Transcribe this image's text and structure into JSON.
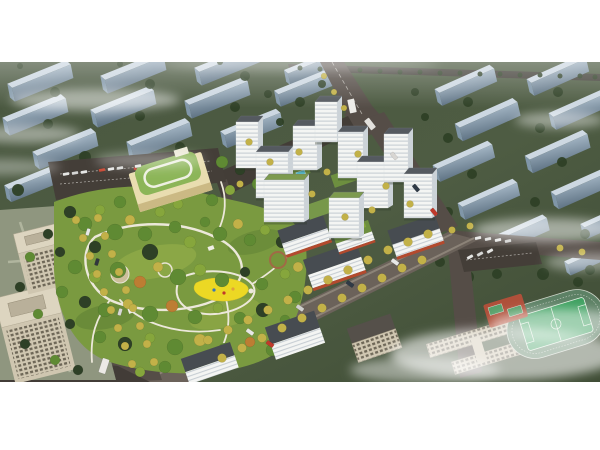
{
  "image": {
    "alt": "Aerial architectural rendering of a residential development: white high-rise towers around green courtyards, a central landscaped park with winding paths and a yellow playground, a kindergarten with green roof, office towers at lower left, a school with sports field at lower right, tree-lined boulevards and rows of background buildings under wisps of cloud",
    "width": 600,
    "height": 320,
    "top_margin": 62,
    "bottom_margin": 68
  },
  "palette": {
    "page_bg": "#ffffff",
    "bg_green": "#4a5840",
    "bg_green_dark": "#3f4d35",
    "slab_top": "#cdd8e2",
    "slab_front_hi": "#a3b5c4",
    "slab_front_lo": "#5f7384",
    "slab_side": "#8096a8",
    "tree_dark": "#2e4026",
    "tree_mid": "#4a6b2f",
    "tree_green": "#5f8a33",
    "tree_light": "#86a63c",
    "tree_yellow": "#c2b148",
    "tree_orange": "#bd7d33",
    "tree_red": "#a34527",
    "road": "#554d47",
    "road_dark": "#423c37",
    "road_light": "#6b625a",
    "parking": "#443e38",
    "path": "#ece8da",
    "park_base": "#7a9a40",
    "park_dark": "#5d7f33",
    "park_light": "#93ac48",
    "playground_yellow": "#ecd824",
    "tower_front": "#f4f5f3",
    "tower_stripe": "#c3cad0",
    "tower_side": "#ccd3d8",
    "tower_roof": "#555a60",
    "tower_roof_green": "#7d9a4e",
    "storefront_red": "#b34a2e",
    "school_wall": "#e9ddb0",
    "school_roof": "#8cb558",
    "office_wall": "#cfc6b0",
    "office_window": "#6e6757",
    "office_roof": "#ddd5c0",
    "field_green": "#3fa161",
    "track_green": "#5d8165",
    "court_red": "#b5503a",
    "pool_blue": "#57c4d6",
    "cloud_white": "#ffffff"
  },
  "scene": {
    "background_slabs": [
      [
        5,
        10,
        -11,
        1
      ],
      [
        98,
        2,
        -11,
        1
      ],
      [
        192,
        -6,
        -11,
        1
      ],
      [
        282,
        -2,
        -11,
        0.85
      ],
      [
        0,
        44,
        -11,
        1
      ],
      [
        88,
        36,
        -11,
        1
      ],
      [
        182,
        27,
        -11,
        1
      ],
      [
        272,
        18,
        -11,
        0.9
      ],
      [
        30,
        78,
        -11,
        1
      ],
      [
        124,
        68,
        -11,
        1
      ],
      [
        218,
        58,
        -11,
        0.95
      ],
      [
        2,
        112,
        -11,
        0.95
      ],
      [
        96,
        102,
        -11,
        0.9
      ],
      [
        432,
        16,
        -13,
        0.95
      ],
      [
        524,
        6,
        -13,
        0.95
      ],
      [
        452,
        50,
        -13,
        1
      ],
      [
        546,
        40,
        -13,
        0.95
      ],
      [
        430,
        92,
        -13,
        0.95
      ],
      [
        522,
        82,
        -13,
        1
      ],
      [
        455,
        130,
        -13,
        0.95
      ],
      [
        548,
        118,
        -13,
        1
      ],
      [
        488,
        165,
        -13,
        0.9
      ],
      [
        578,
        152,
        -13,
        0.85
      ],
      [
        562,
        190,
        -13,
        0.8
      ]
    ],
    "bg_trees": [
      [
        55,
        30,
        5
      ],
      [
        150,
        22,
        5
      ],
      [
        245,
        14,
        5
      ],
      [
        48,
        62,
        5
      ],
      [
        140,
        54,
        5
      ],
      [
        235,
        45,
        5
      ],
      [
        85,
        95,
        6
      ],
      [
        180,
        85,
        5
      ],
      [
        18,
        128,
        6
      ],
      [
        268,
        32,
        4
      ],
      [
        300,
        40,
        5
      ],
      [
        322,
        22,
        4
      ],
      [
        20,
        4,
        3
      ],
      [
        120,
        2,
        3
      ],
      [
        220,
        0,
        3
      ],
      [
        280,
        60,
        4
      ],
      [
        310,
        70,
        4
      ],
      [
        468,
        40,
        5
      ],
      [
        558,
        30,
        5
      ],
      [
        448,
        76,
        5
      ],
      [
        540,
        66,
        5
      ],
      [
        472,
        112,
        5
      ],
      [
        562,
        100,
        5
      ],
      [
        448,
        150,
        5
      ],
      [
        535,
        140,
        5
      ],
      [
        505,
        185,
        6
      ],
      [
        585,
        172,
        5
      ],
      [
        468,
        215,
        6
      ],
      [
        497,
        212,
        5
      ],
      [
        543,
        212,
        6
      ],
      [
        578,
        220,
        5
      ],
      [
        590,
        208,
        5
      ],
      [
        440,
        200,
        5
      ],
      [
        425,
        55,
        4
      ],
      [
        415,
        30,
        4
      ],
      [
        300,
        6,
        2.5
      ],
      [
        320,
        7,
        2.5
      ],
      [
        340,
        8,
        2.5
      ],
      [
        360,
        8,
        2.5
      ],
      [
        380,
        9,
        2.5
      ],
      [
        400,
        10,
        2.5
      ],
      [
        420,
        10,
        2.5
      ],
      [
        440,
        11,
        2.5
      ],
      [
        460,
        11,
        2.5
      ],
      [
        480,
        12,
        2.5
      ],
      [
        500,
        12,
        2.5
      ],
      [
        520,
        13,
        2.5
      ],
      [
        540,
        13,
        2.5
      ],
      [
        560,
        14,
        2.5
      ],
      [
        580,
        14,
        2.5
      ],
      [
        595,
        15,
        2.5
      ]
    ],
    "park_trees": [
      [
        70,
        150,
        6,
        "d"
      ],
      [
        85,
        162,
        7,
        "g"
      ],
      [
        100,
        148,
        5,
        "l"
      ],
      [
        115,
        170,
        8,
        "g"
      ],
      [
        95,
        185,
        6,
        "d"
      ],
      [
        130,
        158,
        5,
        "y"
      ],
      [
        145,
        172,
        7,
        "g"
      ],
      [
        160,
        150,
        5,
        "l"
      ],
      [
        175,
        165,
        6,
        "g"
      ],
      [
        150,
        190,
        8,
        "d"
      ],
      [
        190,
        180,
        6,
        "l"
      ],
      [
        205,
        160,
        5,
        "g"
      ],
      [
        220,
        172,
        7,
        "g"
      ],
      [
        238,
        162,
        5,
        "y"
      ],
      [
        250,
        178,
        6,
        "g"
      ],
      [
        265,
        168,
        5,
        "l"
      ],
      [
        282,
        180,
        6,
        "d"
      ],
      [
        295,
        170,
        5,
        "g"
      ],
      [
        75,
        205,
        7,
        "g"
      ],
      [
        95,
        215,
        6,
        "l"
      ],
      [
        118,
        208,
        8,
        "g"
      ],
      [
        140,
        220,
        6,
        "o"
      ],
      [
        158,
        205,
        5,
        "y"
      ],
      [
        178,
        215,
        8,
        "g"
      ],
      [
        200,
        208,
        6,
        "l"
      ],
      [
        222,
        218,
        7,
        "g"
      ],
      [
        245,
        210,
        5,
        "d"
      ],
      [
        262,
        222,
        6,
        "g"
      ],
      [
        285,
        212,
        5,
        "l"
      ],
      [
        85,
        240,
        6,
        "d"
      ],
      [
        105,
        248,
        7,
        "g"
      ],
      [
        128,
        242,
        5,
        "y"
      ],
      [
        150,
        252,
        8,
        "g"
      ],
      [
        172,
        244,
        6,
        "o"
      ],
      [
        195,
        255,
        7,
        "g"
      ],
      [
        218,
        246,
        5,
        "l"
      ],
      [
        240,
        256,
        6,
        "g"
      ],
      [
        263,
        248,
        7,
        "d"
      ],
      [
        285,
        258,
        5,
        "g"
      ],
      [
        100,
        275,
        6,
        "g"
      ],
      [
        125,
        282,
        7,
        "d"
      ],
      [
        150,
        276,
        5,
        "l"
      ],
      [
        175,
        285,
        8,
        "g"
      ],
      [
        200,
        278,
        6,
        "y"
      ],
      [
        225,
        288,
        7,
        "g"
      ],
      [
        250,
        280,
        5,
        "o"
      ],
      [
        272,
        288,
        6,
        "g"
      ],
      [
        60,
        190,
        5,
        "d"
      ],
      [
        62,
        230,
        6,
        "g"
      ],
      [
        70,
        262,
        5,
        "d"
      ],
      [
        295,
        235,
        6,
        "g"
      ],
      [
        298,
        205,
        5,
        "y"
      ],
      [
        222,
        100,
        6,
        "g"
      ],
      [
        240,
        108,
        5,
        "d"
      ],
      [
        258,
        122,
        6,
        "g"
      ],
      [
        230,
        128,
        5,
        "l"
      ],
      [
        212,
        138,
        6,
        "g"
      ],
      [
        178,
        142,
        5,
        "l"
      ],
      [
        120,
        140,
        6,
        "g"
      ],
      [
        48,
        172,
        5,
        "d"
      ],
      [
        30,
        195,
        5,
        "g"
      ],
      [
        20,
        225,
        5,
        "d"
      ],
      [
        38,
        252,
        5,
        "g"
      ],
      [
        25,
        282,
        5,
        "d"
      ],
      [
        55,
        298,
        5,
        "g"
      ],
      [
        78,
        308,
        5,
        "d"
      ],
      [
        165,
        305,
        6,
        "g"
      ],
      [
        140,
        310,
        5,
        "l"
      ],
      [
        192,
        300,
        5,
        "y"
      ]
    ],
    "street_trees": [
      [
        76,
        158,
        4
      ],
      [
        83,
        176,
        4
      ],
      [
        90,
        194,
        4
      ],
      [
        97,
        212,
        4
      ],
      [
        104,
        230,
        4
      ],
      [
        111,
        248,
        4
      ],
      [
        118,
        266,
        4
      ],
      [
        125,
        284,
        4
      ],
      [
        132,
        302,
        4
      ],
      [
        98,
        156,
        4
      ],
      [
        105,
        174,
        4
      ],
      [
        112,
        192,
        4
      ],
      [
        119,
        210,
        4
      ],
      [
        126,
        228,
        4
      ],
      [
        133,
        246,
        4
      ],
      [
        140,
        264,
        4
      ],
      [
        147,
        282,
        4
      ],
      [
        154,
        300,
        4
      ],
      [
        208,
        278,
        4.5
      ],
      [
        228,
        268,
        4.5
      ],
      [
        248,
        258,
        4.5
      ],
      [
        268,
        248,
        4.5
      ],
      [
        288,
        238,
        4.5
      ],
      [
        308,
        228,
        4.5
      ],
      [
        328,
        218,
        4.5
      ],
      [
        348,
        208,
        4.5
      ],
      [
        368,
        198,
        4.5
      ],
      [
        388,
        188,
        4.5
      ],
      [
        408,
        180,
        4.5
      ],
      [
        428,
        172,
        4.5
      ],
      [
        222,
        296,
        4.5
      ],
      [
        242,
        286,
        4.5
      ],
      [
        262,
        276,
        4.5
      ],
      [
        282,
        266,
        4.5
      ],
      [
        302,
        256,
        4.5
      ],
      [
        322,
        246,
        4.5
      ],
      [
        342,
        236,
        4.5
      ],
      [
        362,
        226,
        4.5
      ],
      [
        382,
        216,
        4.5
      ],
      [
        402,
        206,
        4.5
      ],
      [
        422,
        198,
        4.5
      ],
      [
        249,
        80,
        3.5
      ],
      [
        270,
        100,
        3.5
      ],
      [
        299,
        90,
        3.5
      ],
      [
        327,
        110,
        3.5
      ],
      [
        358,
        92,
        3.5
      ],
      [
        386,
        124,
        3.5
      ],
      [
        410,
        142,
        3.5
      ],
      [
        240,
        122,
        3.5
      ],
      [
        312,
        132,
        3.5
      ],
      [
        345,
        155,
        3.5
      ],
      [
        372,
        148,
        3.5
      ],
      [
        452,
        168,
        3.5
      ],
      [
        470,
        164,
        3.5
      ],
      [
        560,
        186,
        3.5
      ],
      [
        582,
        190,
        3.5
      ],
      [
        334,
        30,
        3
      ],
      [
        344,
        46,
        3
      ],
      [
        324,
        14,
        3
      ]
    ],
    "clouds": [
      [
        95,
        38,
        85,
        11,
        0.5
      ],
      [
        25,
        72,
        55,
        9,
        0.45
      ],
      [
        150,
        98,
        55,
        8,
        0.35
      ],
      [
        560,
        58,
        45,
        8,
        0.45
      ],
      [
        548,
        168,
        75,
        12,
        0.5
      ],
      [
        590,
        200,
        45,
        9,
        0.4
      ],
      [
        505,
        292,
        115,
        26,
        0.6
      ],
      [
        560,
        262,
        70,
        15,
        0.5
      ],
      [
        425,
        308,
        75,
        13,
        0.45
      ],
      [
        300,
        2,
        140,
        6,
        0.3
      ],
      [
        0,
        105,
        60,
        8,
        0.35
      ]
    ],
    "towers": [
      [
        236,
        60,
        22,
        46
      ],
      [
        256,
        90,
        32,
        46
      ],
      [
        293,
        64,
        24,
        44
      ],
      [
        315,
        40,
        22,
        40
      ],
      [
        338,
        70,
        25,
        46
      ],
      [
        357,
        100,
        31,
        46
      ],
      [
        264,
        118,
        40,
        42,
        "g"
      ],
      [
        329,
        136,
        30,
        40,
        "g"
      ],
      [
        384,
        72,
        24,
        48
      ],
      [
        404,
        112,
        28,
        44
      ]
    ],
    "cars": [
      [
        352,
        44,
        7,
        14,
        "#edece8",
        -12
      ],
      [
        370,
        62,
        6,
        12,
        "#e2e0dc",
        -38
      ],
      [
        394,
        94,
        4,
        8,
        "#d8d6d2",
        -40
      ],
      [
        416,
        126,
        4,
        8,
        "#2f3a46",
        -40
      ],
      [
        434,
        150,
        4,
        8,
        "#c0392b",
        -40
      ],
      [
        66,
        112,
        3,
        6.5,
        "#e6e6e4",
        80
      ],
      [
        75,
        111,
        3,
        6.5,
        "#d5d5d3",
        80
      ],
      [
        84,
        110,
        3,
        6.5,
        "#e6e6e4",
        80
      ],
      [
        102,
        108,
        3,
        6.5,
        "#c74a35",
        80
      ],
      [
        111,
        107,
        3,
        6.5,
        "#e6e6e4",
        80
      ],
      [
        120,
        106,
        3,
        6.5,
        "#dadad8",
        80
      ],
      [
        138,
        104,
        3,
        6.5,
        "#e6e6e4",
        80
      ],
      [
        88,
        170,
        3.5,
        7,
        "#e8e8e6",
        17
      ],
      [
        120,
        250,
        3.5,
        7,
        "#d8d8d6",
        17
      ],
      [
        97,
        200,
        3.5,
        7,
        "#30363e",
        17
      ],
      [
        250,
        270,
        4,
        8,
        "#e8e8e6",
        -55
      ],
      [
        300,
        246,
        4,
        8,
        "#d0d0ce",
        -55
      ],
      [
        350,
        222,
        4,
        8,
        "#2f3a46",
        -55
      ],
      [
        395,
        200,
        4,
        8,
        "#e8e8e6",
        -55
      ],
      [
        270,
        282,
        4,
        8,
        "#c0392b",
        -55
      ],
      [
        478,
        176,
        3,
        6.5,
        "#e8e8e6",
        78
      ],
      [
        488,
        177,
        3,
        6.5,
        "#dcdcda",
        78
      ],
      [
        498,
        178,
        3,
        6.5,
        "#e8e8e6",
        78
      ],
      [
        508,
        179,
        3,
        6.5,
        "#d0d0ce",
        78
      ],
      [
        470,
        195,
        3,
        6.5,
        "#e6e6e4",
        60
      ],
      [
        480,
        192,
        3,
        6.5,
        "#d8d8d6",
        60
      ],
      [
        490,
        189,
        3,
        6.5,
        "#e6e6e4",
        60
      ],
      [
        104,
        304,
        7,
        15,
        "#eceae6",
        18
      ]
    ]
  }
}
